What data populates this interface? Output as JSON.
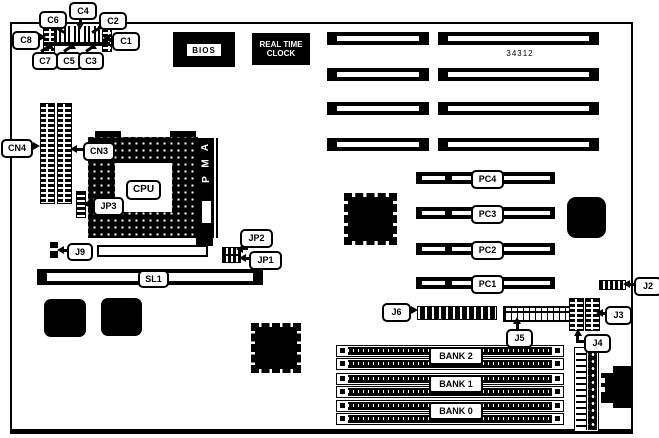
{
  "diagram": {
    "title": "motherboard layout diagram",
    "part_number": "34312",
    "bios_label": "BIOS",
    "rtc_lines": [
      "REAL TIME",
      "CLOCK"
    ],
    "amp_letters": [
      "A",
      "M",
      "P"
    ],
    "callouts": {
      "c1": "C1",
      "c2": "C2",
      "c3": "C3",
      "c4": "C4",
      "c5": "C5",
      "c6": "C6",
      "c7": "C7",
      "c8": "C8",
      "cn3": "CN3",
      "cn4": "CN4",
      "jp1": "JP1",
      "jp2": "JP2",
      "jp3": "JP3",
      "j2": "J2",
      "j3": "J3",
      "j4": "J4",
      "j5": "J5",
      "j6": "J6",
      "j9": "J9",
      "cpu": "CPU",
      "sl1": "SL1",
      "pc1": "PC1",
      "pc2": "PC2",
      "pc3": "PC3",
      "pc4": "PC4",
      "bank0": "BANK 0",
      "bank1": "BANK 1",
      "bank2": "BANK 2"
    },
    "colors": {
      "foreground": "#000000",
      "background": "#ffffff"
    }
  }
}
